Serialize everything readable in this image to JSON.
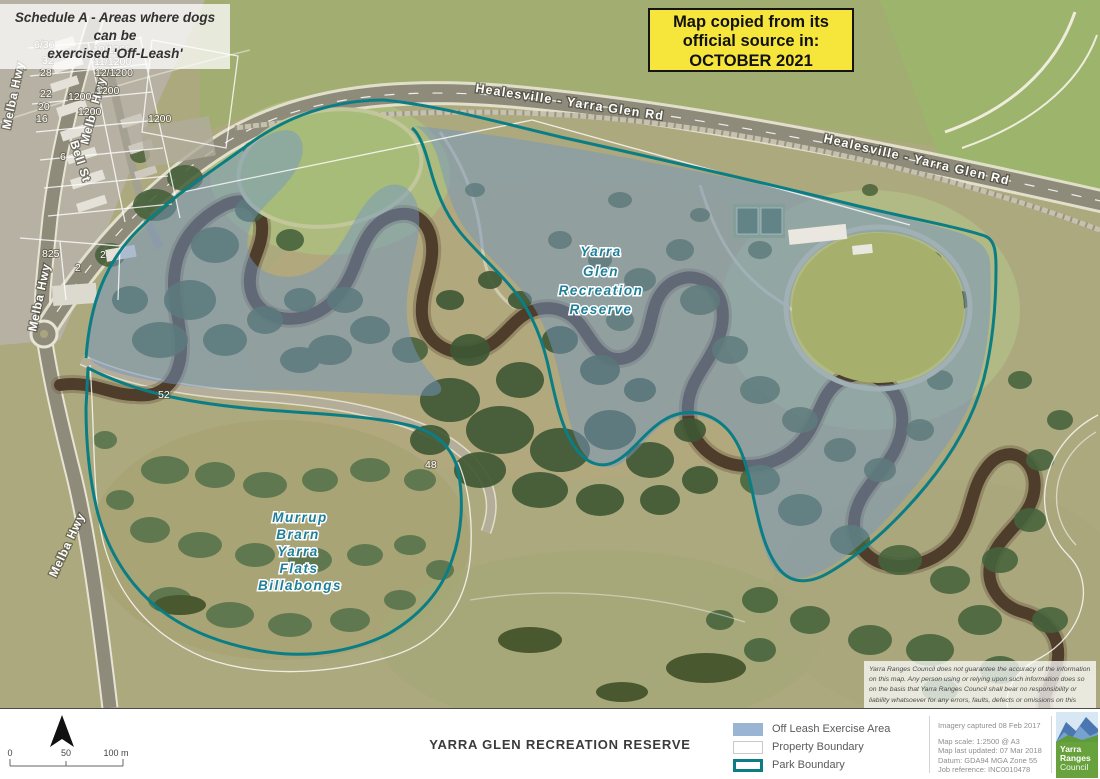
{
  "overlays": {
    "schedule_note_line1": "Schedule A - Areas where dogs can be",
    "schedule_note_line2": "exercised 'Off-Leash'",
    "source_box": {
      "line1": "Map copied from its",
      "line2": "official source in:",
      "line3": "OCTOBER 2021"
    },
    "disclaimer": "Yarra Ranges Council does not guarantee the accuracy of the information on this map. Any person using or relying upon such information does so on the basis that Yarra Ranges Council shall bear no responsibility or liability whatsoever for any errors, faults, defects or omissions on this map."
  },
  "map": {
    "road_label_1": "Healesville - Yarra Glen Rd",
    "road_label_2": "Healesville - Yarra Glen Rd",
    "street_labels": {
      "melba_1": "Melba Hwy",
      "melba_2": "Melba Hwy",
      "melba_3": "Melba Hwy",
      "melba_4": "Melba Hwy",
      "bell": "Bell St"
    },
    "reserve_label": {
      "l1": "Yarra",
      "l2": "Glen",
      "l3": "Recreation",
      "l4": "Reserve"
    },
    "billabong_label": {
      "l1": "Murrup",
      "l2": "Brarn",
      "l3": "Yarra",
      "l4": "Flats",
      "l5": "Billabongs"
    },
    "parcels": {
      "p1": "6/36",
      "p2": "32",
      "p3": "28",
      "p4": "22",
      "p5": "20",
      "p6": "16",
      "p7": "6",
      "p8": "10/1200",
      "p9": "11/1200",
      "p10": "12/1200",
      "p11": "1200",
      "p12": "1200",
      "p13": "1200",
      "p14": "1200",
      "p15": "825",
      "p16": "2",
      "p17": "2",
      "p18": "52",
      "p19": "48"
    },
    "colors": {
      "off_leash_fill": "#7495c2",
      "park_boundary": "#0b7e85",
      "property_boundary": "#ffffff",
      "source_box_bg": "#f6e63b"
    }
  },
  "footer": {
    "title": "YARRA GLEN RECREATION RESERVE",
    "scalebar": {
      "start": "0",
      "mid": "50",
      "end": "100 m"
    },
    "legend": {
      "off_leash": "Off Leash Exercise Area",
      "property": "Property Boundary",
      "park": "Park Boundary"
    },
    "meta": {
      "imagery": "Imagery captured 08 Feb 2017",
      "scale": "Map scale: 1:2500 @ A3",
      "updated": "Map last updated: 07 Mar 2018",
      "datum": "Datum: GDA94 MGA Zone 55",
      "job": "Job reference: INC0010478"
    },
    "logo": {
      "l1": "Yarra",
      "l2": "Ranges",
      "l3": "Council"
    }
  }
}
